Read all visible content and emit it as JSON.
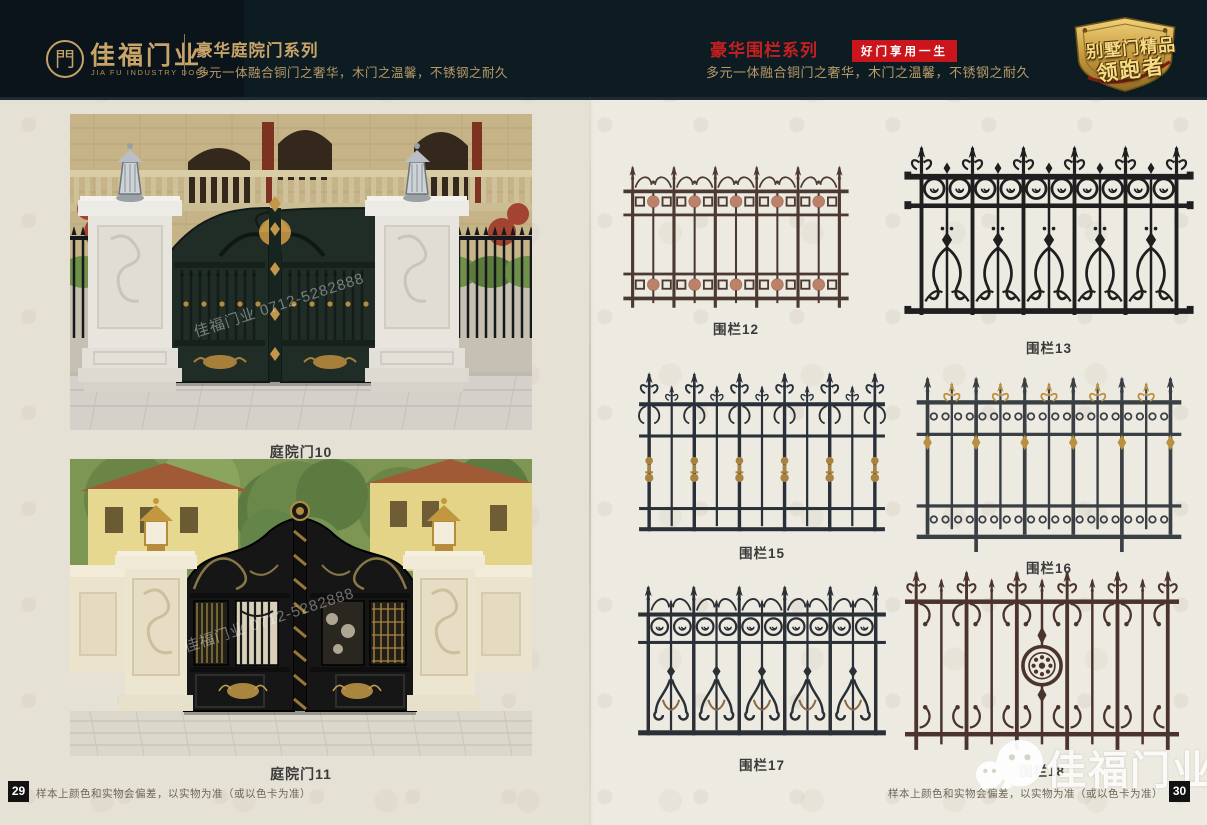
{
  "header": {
    "logo": {
      "glyph": "門",
      "brand": "佳福门业",
      "brand_en": "JIA FU INDUSTRY DOOR"
    },
    "left_series": {
      "title": "豪华庭院门系列",
      "subtitle": "多元一体融合铜门之奢华，木门之温馨，不锈钢之耐久"
    },
    "right_series": {
      "title": "豪华围栏系列",
      "badge": "好门享用一生",
      "subtitle": "多元一体融合铜门之奢华，木门之温馨，不锈钢之耐久"
    },
    "emblem": {
      "line1": "别墅门精品",
      "line2": "领跑者"
    },
    "colors": {
      "header_bg": "#0d1b22",
      "gold": "#c9a468",
      "red": "#c9151b",
      "page_bg": "#edeae1"
    }
  },
  "gates": [
    {
      "label": "庭院门10"
    },
    {
      "label": "庭院门11"
    }
  ],
  "fences": [
    {
      "label": "围栏12",
      "pattern": "rosette-bands",
      "frame": "#4b3a32",
      "accent": "#bd8168"
    },
    {
      "label": "围栏13",
      "pattern": "scroll-black",
      "frame": "#1f1f1f",
      "accent": "#1f1f1f"
    },
    {
      "label": "围栏15",
      "pattern": "fleur-collar",
      "frame": "#293039",
      "accent": "#a8823f"
    },
    {
      "label": "围栏16",
      "pattern": "gold-mixed",
      "frame": "#3a3f44",
      "accent": "#b9903f"
    },
    {
      "label": "围栏17",
      "pattern": "heart-scroll",
      "frame": "#2a3036",
      "accent": "#8a6a42"
    },
    {
      "label": "围栏18",
      "pattern": "medallion",
      "frame": "#4b342d",
      "accent": "#4b342d"
    }
  ],
  "watermark": {
    "photo_text": "佳福门业 0712-5282888",
    "brand": "佳福门业"
  },
  "footer": {
    "left_page": "29",
    "right_page": "30",
    "note": "样本上颜色和实物会偏差，以实物为准（或以色卡为准）"
  }
}
